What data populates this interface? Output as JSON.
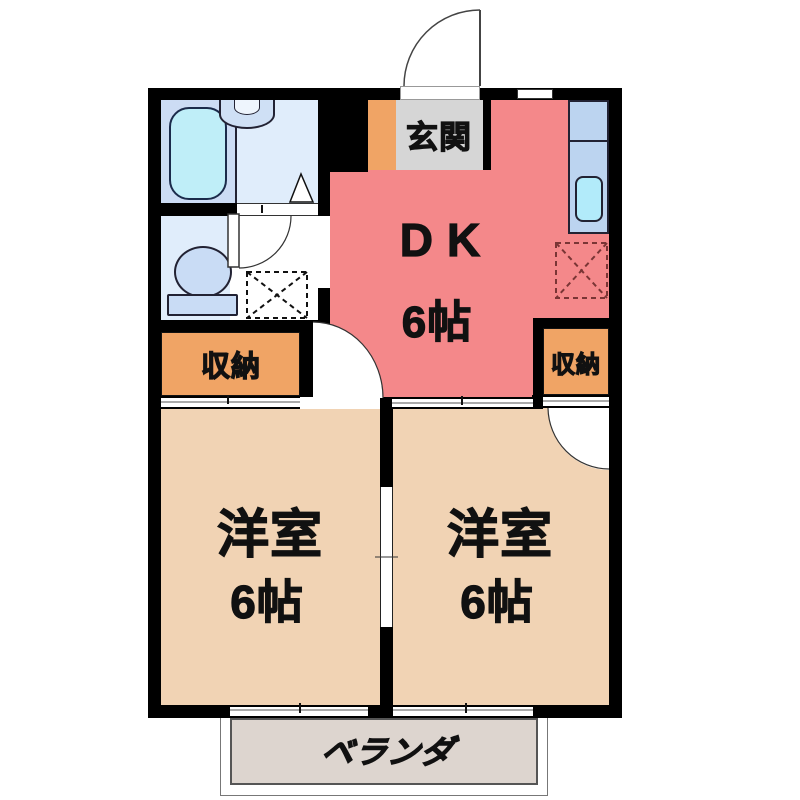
{
  "floorplan": {
    "entrance": {
      "label": "玄関"
    },
    "dk": {
      "label": "DK",
      "size": "6帖"
    },
    "closet_left": {
      "label": "収納"
    },
    "closet_right": {
      "label": "収納"
    },
    "western_room_left": {
      "label": "洋室",
      "size": "6帖"
    },
    "western_room_right": {
      "label": "洋室",
      "size": "6帖"
    },
    "balcony": {
      "label": "ベランダ"
    },
    "fixtures": {
      "bathtub": "bathtub",
      "washbasin": "washbasin",
      "toilet": "toilet",
      "kitchen_counter": "kitchen-counter",
      "kitchen_sink": "kitchen-sink",
      "washing_machine_space": "washing-machine-space",
      "refrigerator_space": "refrigerator-space",
      "entrance_door": "entrance-door-swing",
      "room_doors": "hinged-door-swings",
      "sliding_doors": "sliding-door-thresholds",
      "windows": "sliding-windows"
    },
    "colors": {
      "wall": "#000000",
      "dk_floor": "#f4888a",
      "room_floor": "#f1d3b4",
      "closet_floor": "#f0a465",
      "entrance_mat": "#d6d6d6",
      "balcony_floor": "#ddd5cf",
      "bath_floor": "#ccdcf4",
      "washroom_floor": "#e0edfb",
      "bathtub": "#bfeef8",
      "kitchen_counter": "#bcd4f0",
      "kitchen_sink": "#b2ebfa",
      "sanitary_fixture": "#c9dcf5"
    }
  }
}
